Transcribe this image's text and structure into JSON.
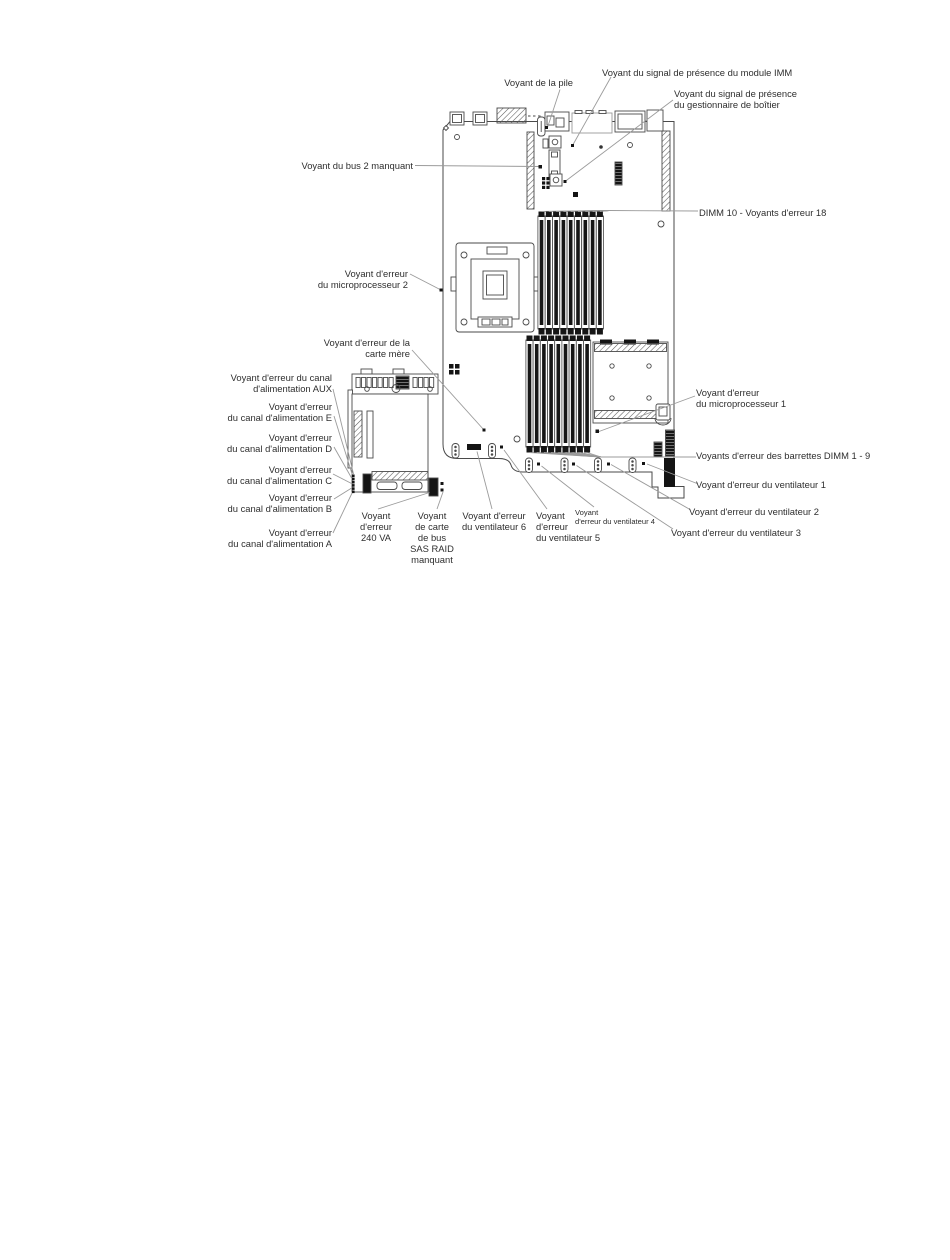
{
  "diagram": {
    "colors": {
      "component_line": "#4a4a4a",
      "leader_line": "#999999",
      "text": "#2e2e2e",
      "black_fill": "#161616",
      "background": "#ffffff"
    },
    "labels": {
      "battery": "Voyant de la pile",
      "imm_presence": "Voyant du signal de présence du module IMM",
      "enclosure_presence": "Voyant du signal de présence\ndu gestionnaire de boîtier",
      "dimm_10_18": "DIMM 10 - Voyants d'erreur 18",
      "bus_2_missing": "Voyant du bus 2 manquant",
      "microprocessor_2": "Voyant d'erreur\ndu microprocesseur 2",
      "system_board": "Voyant d'erreur de la\ncarte mère",
      "power_channel_aux": "Voyant d'erreur du canal\nd'alimentation AUX",
      "power_channel_e": "Voyant d'erreur\ndu canal d'alimentation E",
      "power_channel_d": "Voyant d'erreur\ndu canal d'alimentation D",
      "power_channel_c": "Voyant d'erreur\ndu canal d'alimentation C",
      "power_channel_b": "Voyant d'erreur\ndu canal d'alimentation B",
      "power_channel_a": "Voyant d'erreur\ndu canal d'alimentation A",
      "error_240va": "Voyant\nd'erreur\n240 VA",
      "sas_raid_missing": "Voyant\nde carte\nde bus\nSAS RAID\nmanquant",
      "fan_6": "Voyant d'erreur\ndu ventilateur 6",
      "fan_5": "Voyant\nd'erreur\ndu ventilateur 5",
      "fan_4": "Voyant\nd'erreur du ventilateur 4",
      "fan_3": "Voyant d'erreur du ventilateur 3",
      "fan_2": "Voyant d'erreur du ventilateur 2",
      "fan_1": "Voyant d'erreur du ventilateur 1",
      "dimm_1_9": "Voyants d'erreur des barrettes DIMM 1 - 9",
      "microprocessor_1": "Voyant d'erreur\ndu microprocesseur 1"
    }
  }
}
